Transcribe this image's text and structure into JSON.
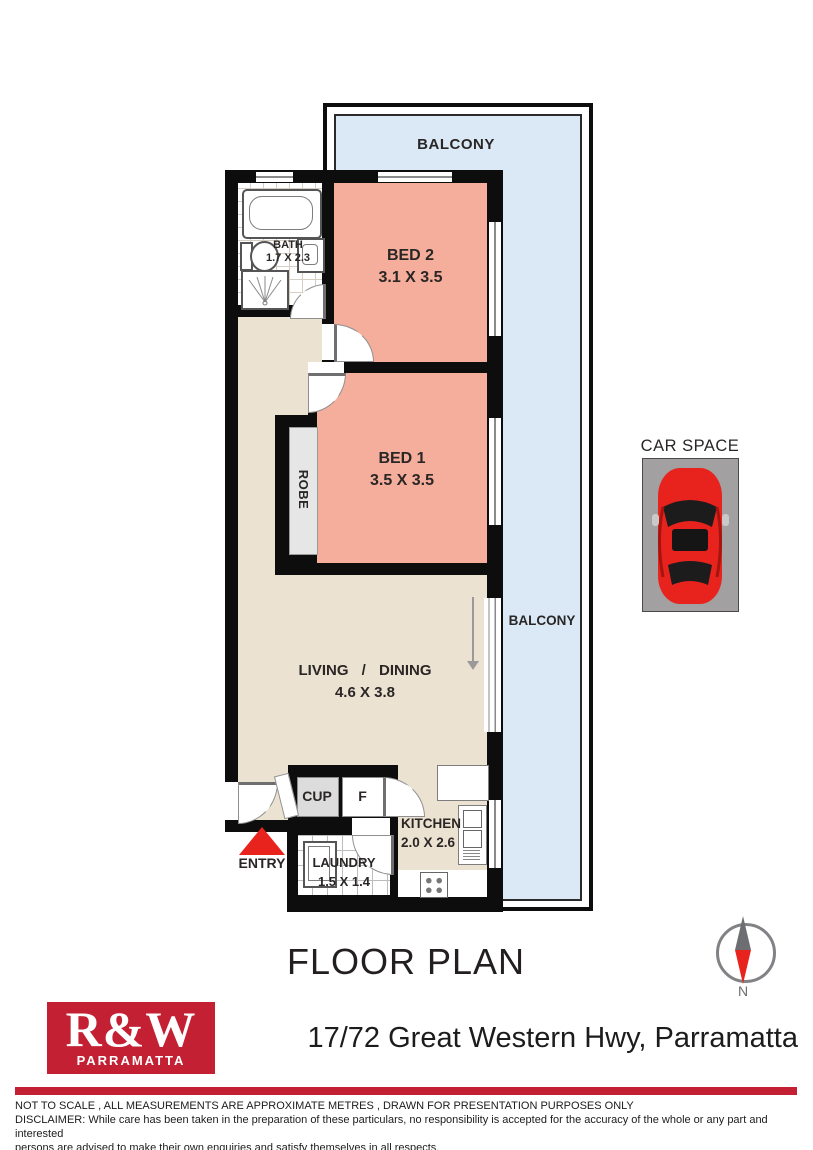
{
  "title": "FLOOR PLAN",
  "compass": {
    "north_label": "N"
  },
  "colors": {
    "wall": "#0d0d0d",
    "balcony_fill": "#dbe9f6",
    "bedroom_fill": "#f4ae9b",
    "living_fill": "#ece2d1",
    "robe_fill": "#e6e6e6",
    "car_space_fill": "#a2a0a1",
    "accent_red": "#e8231d",
    "brand_red": "#c32033"
  },
  "plan": {
    "balcony_top_label": "BALCONY",
    "balcony_right_label": "BALCONY",
    "rooms": {
      "bed2": {
        "name": "BED 2",
        "dims": "3.1 X 3.5"
      },
      "bed1": {
        "name": "BED 1",
        "dims": "3.5 X 3.5"
      },
      "bath": {
        "name": "BATH",
        "dims": "1.7 X 2.3"
      },
      "living": {
        "name": "LIVING / DINING",
        "dims": "4.6 X 3.8"
      },
      "kitchen": {
        "name": "KITCHEN",
        "dims": "2.0 X 2.6"
      },
      "laundry": {
        "name": "LAUNDRY",
        "dims": "1.5 X 1.4"
      },
      "robe": {
        "name": "ROBE"
      },
      "cupboard": {
        "name": "CUP"
      },
      "fridge": {
        "name": "F"
      }
    },
    "entry_label": "ENTRY",
    "car_space_label": "CAR SPACE"
  },
  "footer": {
    "logo_brand": "R&W",
    "logo_suburb": "PARRAMATTA",
    "address": "17/72 Great Western Hwy, Parramatta",
    "note": "NOT TO SCALE , ALL MEASUREMENTS ARE APPROXIMATE METRES , DRAWN FOR PRESENTATION PURPOSES ONLY",
    "disclaimer_line1": "DISCLAIMER:  While care has been taken in the preparation of these particulars, no responsibility is accepted for the accuracy of the whole or any part and interested",
    "disclaimer_line2": "persons are advised to make their own enquiries and satisfy  themselves in all respects."
  }
}
